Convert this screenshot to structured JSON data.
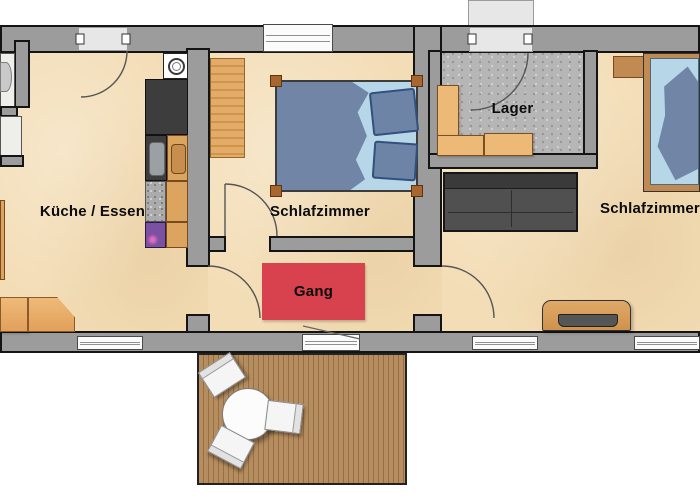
{
  "page": {
    "type": "apartment-floor-plan"
  },
  "rooms": {
    "kitchen": {
      "label": "Küche / Essen"
    },
    "bedroom_middle": {
      "label": "Schlafzimmer"
    },
    "storage": {
      "label": "Lager"
    },
    "bedroom_right": {
      "label": "Schlafzimmer"
    },
    "hallway": {
      "label": "Gang"
    }
  },
  "colors": {
    "wall": "#9c9c9c",
    "wall-outline": "#141414",
    "floor-tan": "#f3ddb6",
    "concrete": "#b6b6b6",
    "rug-red": "#d8424e",
    "deck-wood": "#b68d60",
    "deck-stripe": "#96703f",
    "bed-blue": "#7186a6",
    "sheet-blue": "#b7d7e8",
    "cabinet-wood": "#dba45f",
    "counter-dark": "#3d3d3d",
    "appliance-purple": "#7b51a1",
    "sofa-gray": "#505050"
  }
}
